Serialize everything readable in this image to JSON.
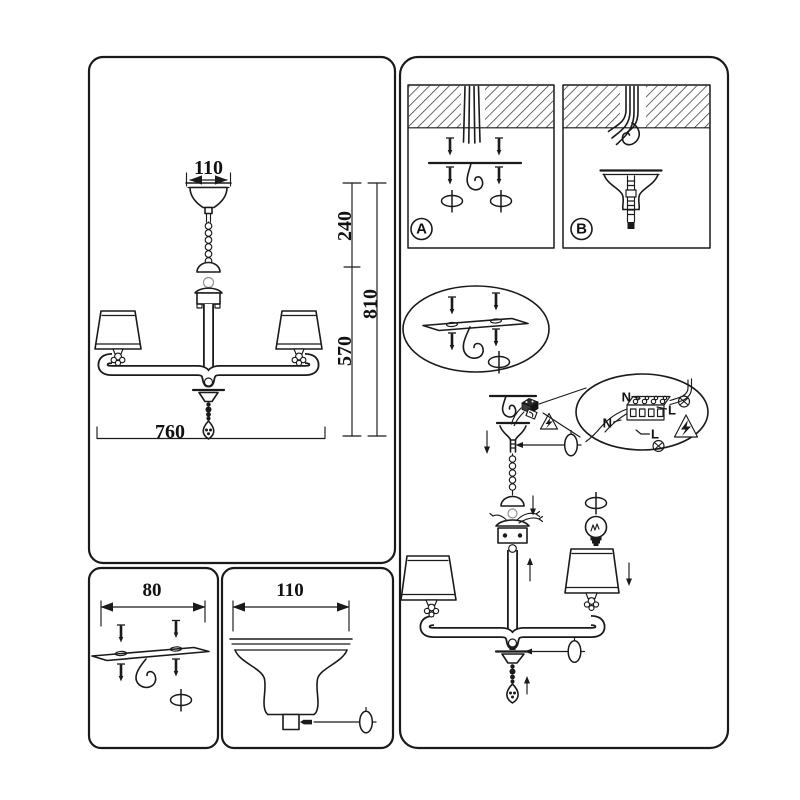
{
  "document": {
    "kind": "chandelier-installation-instruction-sheet",
    "colors": {
      "ink": "#1a1a1a",
      "paper": "#ffffff"
    },
    "icons": [
      "screwdriver-icon",
      "screw-icon",
      "ceiling-hook-icon",
      "warning-electricity-icon",
      "ground-terminal-icon",
      "light-bulb-icon",
      "arrow-up-icon",
      "arrow-down-icon"
    ]
  },
  "dimension_panel": {
    "canopy_width": "110",
    "hanger_height": "240",
    "overall_height": "810",
    "fixture_height": "570",
    "fixture_width": "760"
  },
  "bracket_panel": {
    "bracket_width": "80"
  },
  "canopy_panel": {
    "canopy_width": "110"
  },
  "install_panel": {
    "step_a_label": "A",
    "step_b_label": "B",
    "wiring_labels": {
      "neutral_top": "N",
      "line_top": "L",
      "neutral_bottom": "N",
      "line_bottom": "L"
    }
  }
}
